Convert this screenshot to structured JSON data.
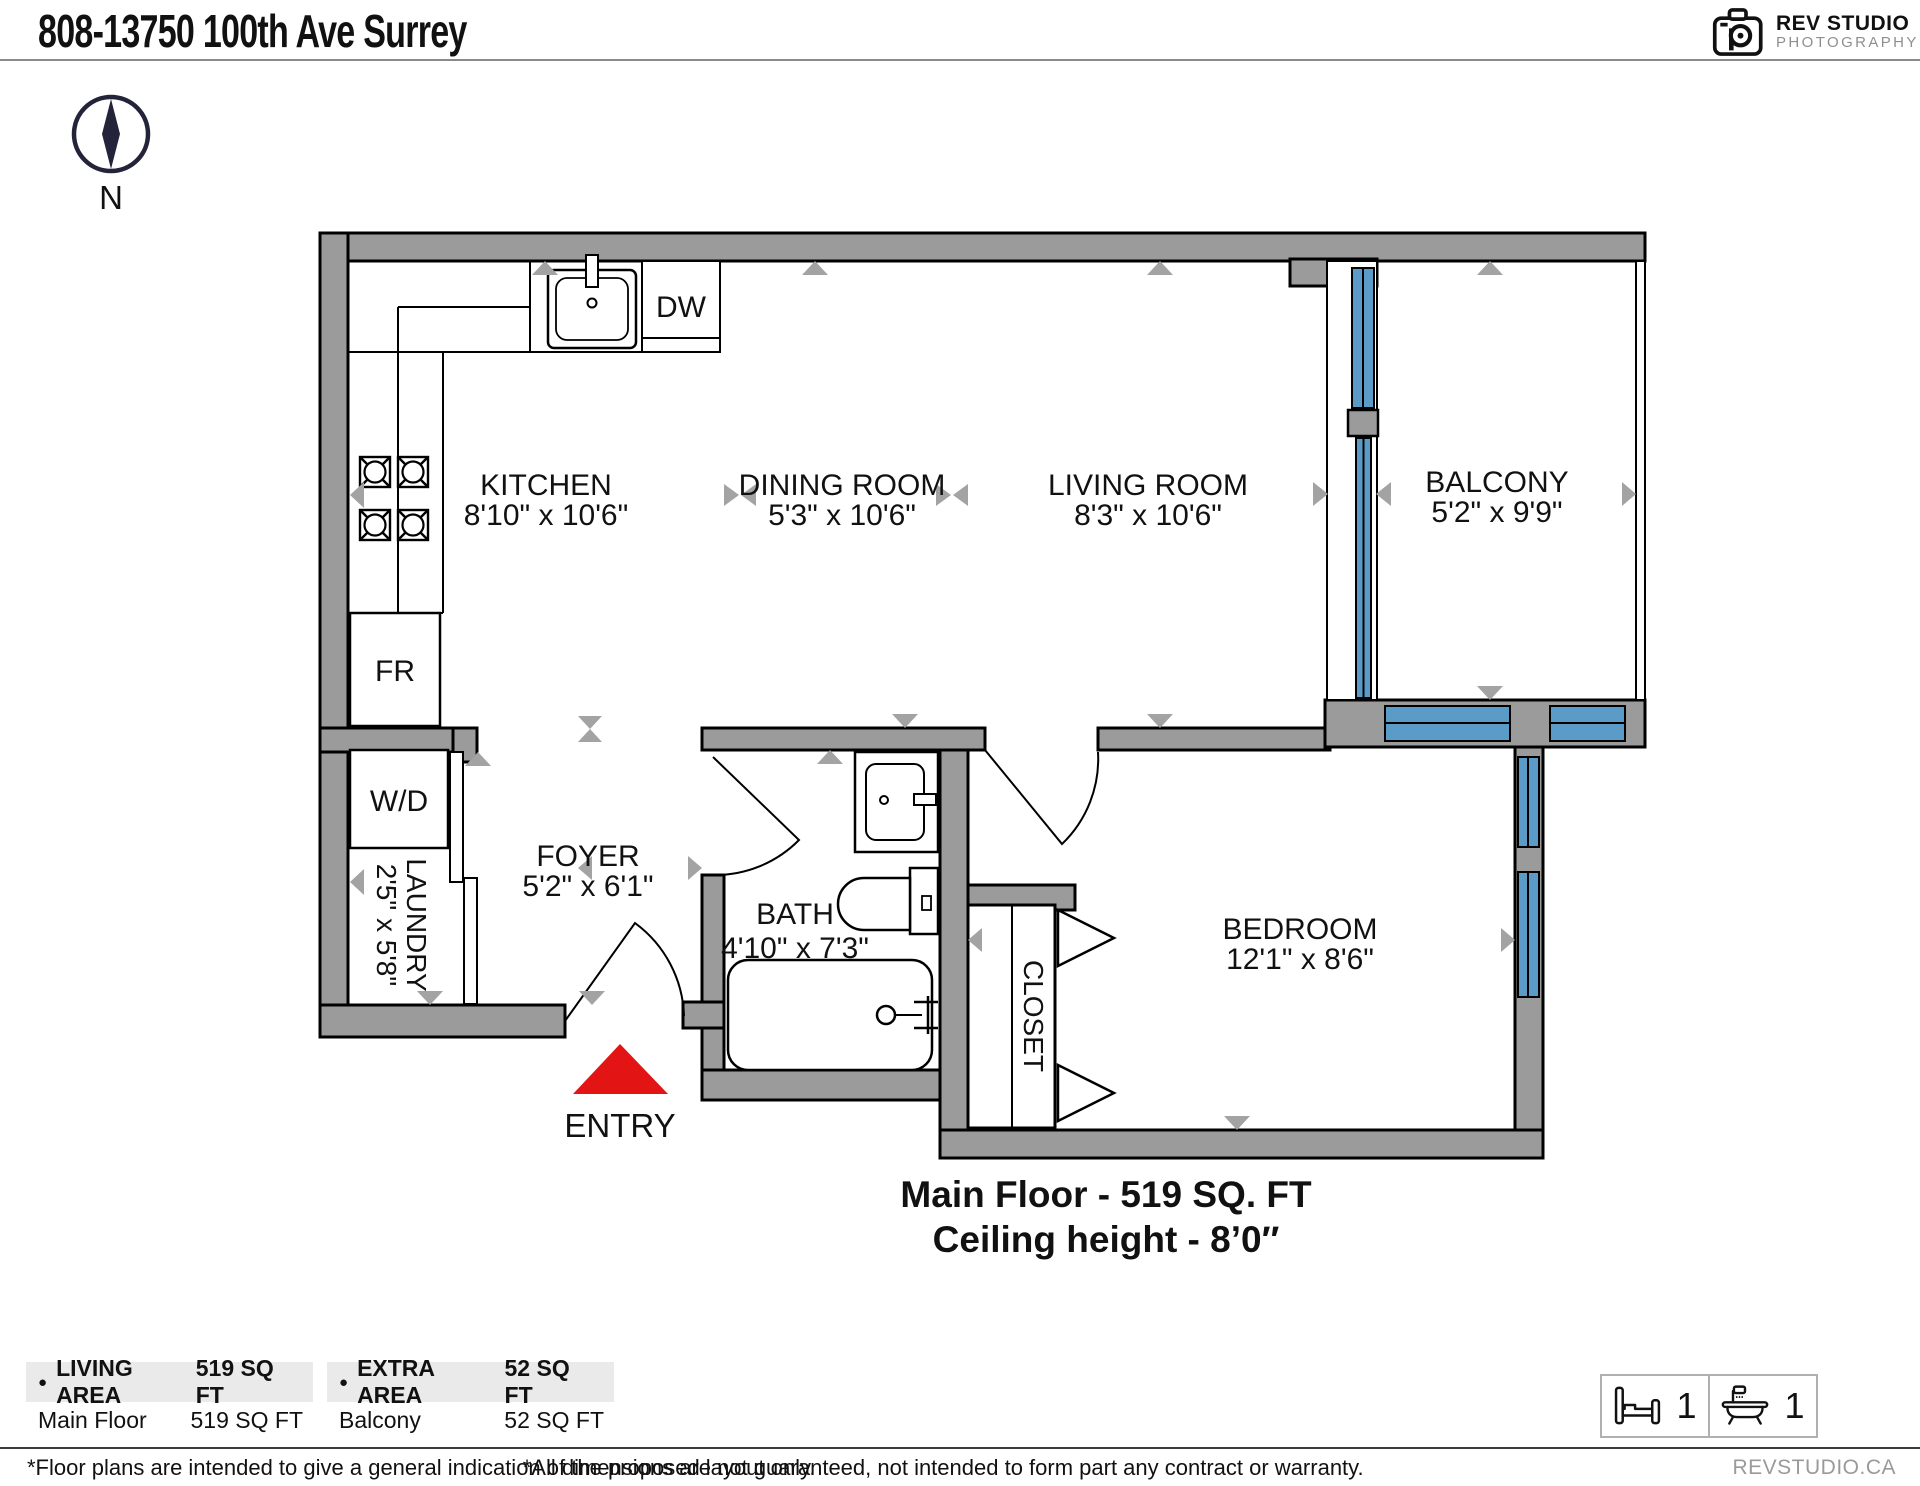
{
  "header": {
    "title": "808-13750 100th Ave Surrey",
    "logo_name": "REV STUDIO",
    "logo_sub": "PHOTOGRAPHY"
  },
  "compass": {
    "north": "N"
  },
  "rooms": {
    "kitchen": {
      "label": "KITCHEN",
      "dims": "8'10\" x 10'6\""
    },
    "dining": {
      "label": "DINING ROOM",
      "dims": "5'3\" x 10'6\""
    },
    "living": {
      "label": "LIVING ROOM",
      "dims": "8'3\" x 10'6\""
    },
    "balcony": {
      "label": "BALCONY",
      "dims": "5'2\" x 9'9\""
    },
    "foyer": {
      "label": "FOYER",
      "dims": "5'2\" x 6'1\""
    },
    "bath": {
      "label": "BATH",
      "dims": "4'10\" x 7'3\""
    },
    "laundry": {
      "label": "LAUNDRY",
      "dims": "2'5\" x 5'8\""
    },
    "bedroom": {
      "label": "BEDROOM",
      "dims": "12'1\" x 8'6\""
    },
    "closet": {
      "label": "CLOSET"
    }
  },
  "fixtures": {
    "dishwasher": "DW",
    "fridge": "FR",
    "washer_dryer": "W/D"
  },
  "entry_label": "ENTRY",
  "floor_summary": {
    "line1": "Main Floor - 519 SQ. FT",
    "line2": "Ceiling height - 8’0″"
  },
  "legend": {
    "bullet": "●",
    "living": {
      "title": "LIVING AREA",
      "total": "519 SQ FT",
      "row_label": "Main Floor",
      "row_value": "519 SQ FT"
    },
    "extra": {
      "title": "EXTRA AREA",
      "total": "52 SQ FT",
      "row_label": "Balcony",
      "row_value": "52 SQ FT"
    }
  },
  "counts": {
    "beds": "1",
    "baths": "1"
  },
  "footer": {
    "left": "*Floor plans are intended to give a general indication of the proposed layout only.",
    "center": "*All dimensions are not guaranteed, not intended to form part any contract or warranty.",
    "right": "REVSTUDIO.CA"
  },
  "colors": {
    "wall_gray": "#9b9b9b",
    "window_blue": "#5b9bc8",
    "entry_red": "#e31414",
    "marker_gray": "#a3a3a3"
  }
}
